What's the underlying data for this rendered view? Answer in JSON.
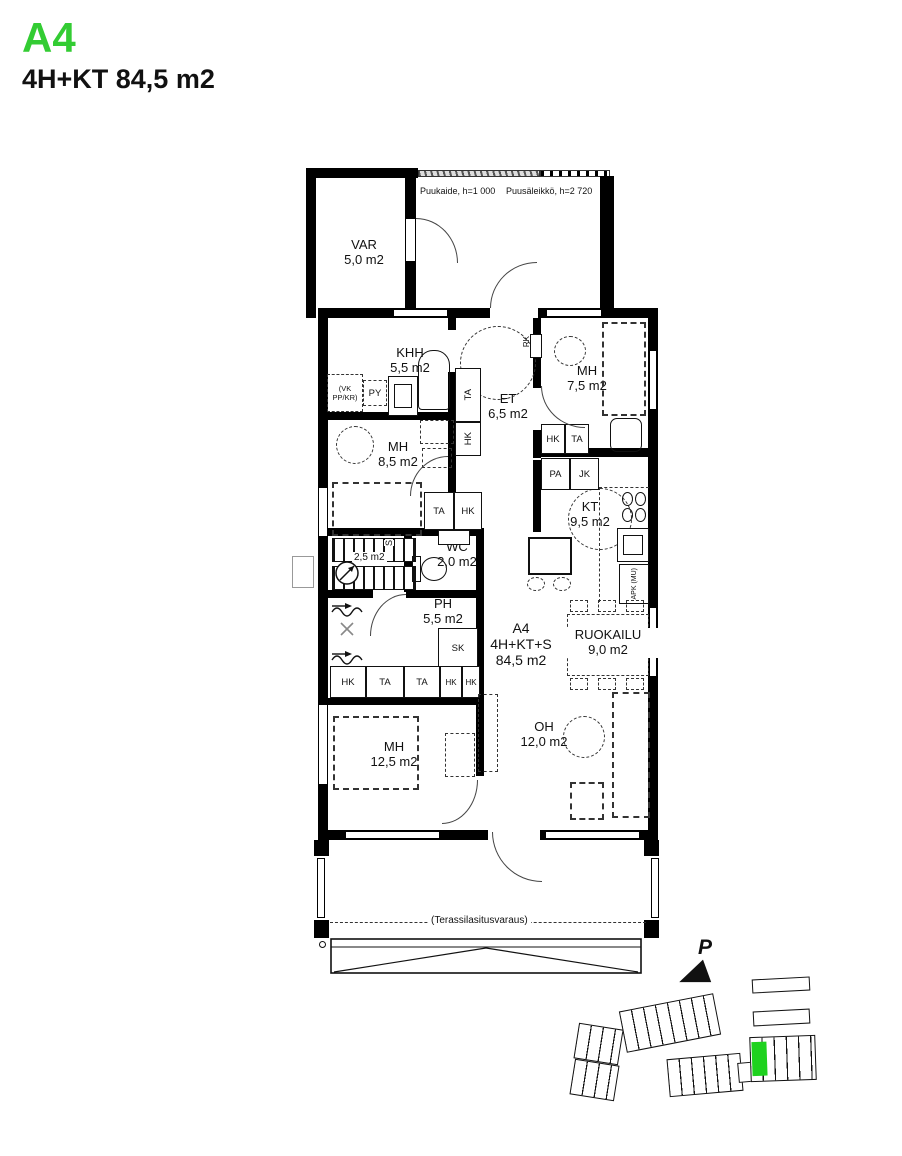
{
  "colors": {
    "accent_green": "#33CC33",
    "site_highlight": "#1ED21E",
    "wall": "#000000"
  },
  "header": {
    "unit_id": "A4",
    "unit_spec": "4H+KT 84,5 m2"
  },
  "unit_label": {
    "id": "A4",
    "type": "4H+KT+S",
    "area": "84,5 m2"
  },
  "annotations": {
    "puukaide": "Puukaide, h=1 000",
    "puusaleikko": "Puusäleikkö, h=2 720",
    "terassilasitus": "(Terassilasitusvaraus)",
    "stairs_area": "2,5 m2",
    "stairs_code": "S"
  },
  "rooms": {
    "var": {
      "name": "VAR",
      "area": "5,0 m2"
    },
    "khh": {
      "name": "KHH",
      "area": "5,5 m2"
    },
    "mh1": {
      "name": "MH",
      "area": "7,5 m2"
    },
    "et": {
      "name": "ET",
      "area": "6,5 m2"
    },
    "mh2": {
      "name": "MH",
      "area": "8,5 m2"
    },
    "kt": {
      "name": "KT",
      "area": "9,5 m2"
    },
    "wc": {
      "name": "WC",
      "area": "2,0 m2"
    },
    "ph": {
      "name": "PH",
      "area": "5,5 m2"
    },
    "ruokailu": {
      "name": "RUOKAILU",
      "area": "9,0 m2"
    },
    "oh": {
      "name": "OH",
      "area": "12,0 m2"
    },
    "mh3": {
      "name": "MH",
      "area": "12,5 m2"
    }
  },
  "fixtures": {
    "hk": "HK",
    "ta": "TA",
    "pa": "PA",
    "jk": "JK",
    "sk": "SK",
    "py": "PY",
    "vk_ppkr": "(VK PP/KR)",
    "apk_mu": "APK (MU)",
    "rk": "RK"
  },
  "site_plan": {
    "north_label": "P"
  }
}
